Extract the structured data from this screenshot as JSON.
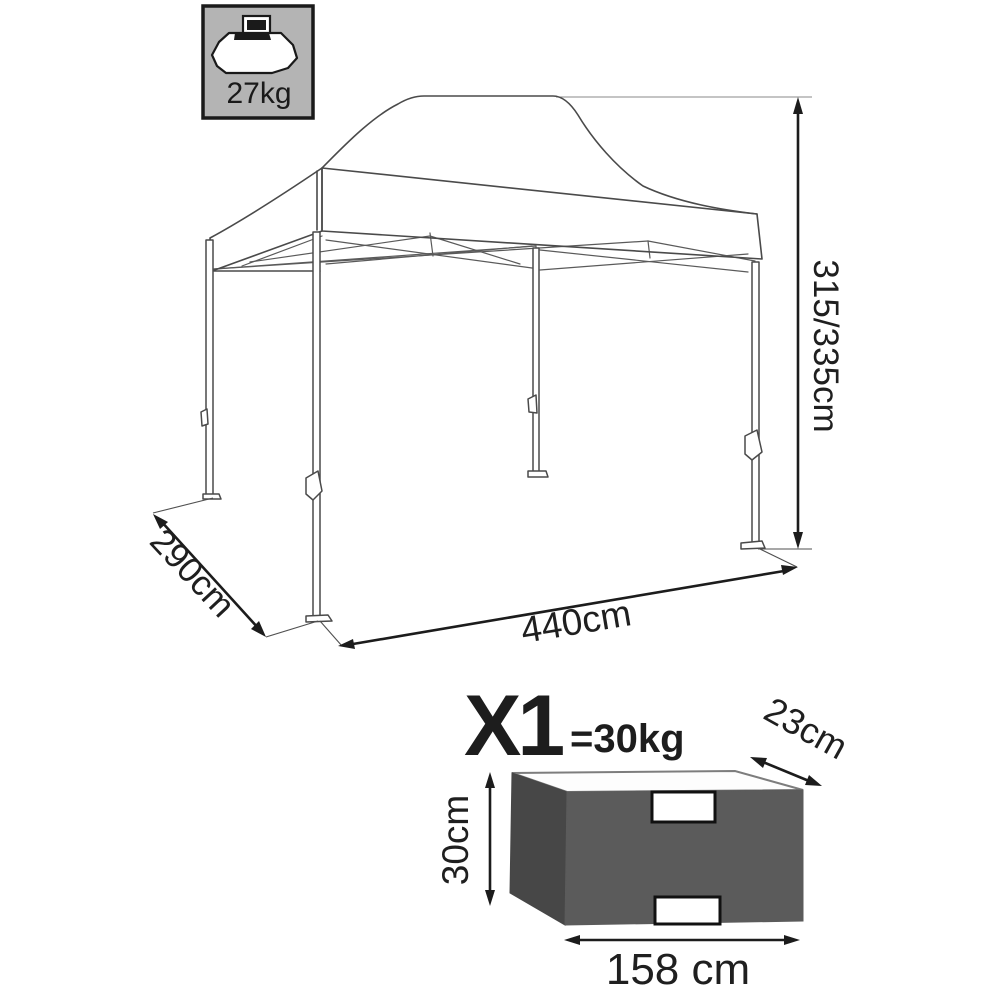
{
  "capacity_badge": {
    "weight": "27kg",
    "icon": "weight-icon"
  },
  "gazebo": {
    "height": "315/335cm",
    "depth": "290cm",
    "width": "440cm"
  },
  "package": {
    "quantity": "X1",
    "weight": "=30kg",
    "depth": "23cm",
    "height": "30cm",
    "width": "158 cm"
  },
  "colors": {
    "background": "#ffffff",
    "line": "#4a4a4a",
    "dimension": "#1c1c1c",
    "badge_bg": "#b4b4b4",
    "badge_border": "#1a1a1a",
    "box_front": "#5b5b5b",
    "box_side": "#474747",
    "box_top": "#fdfdfd",
    "box_top_stroke": "#7d7d7d"
  }
}
